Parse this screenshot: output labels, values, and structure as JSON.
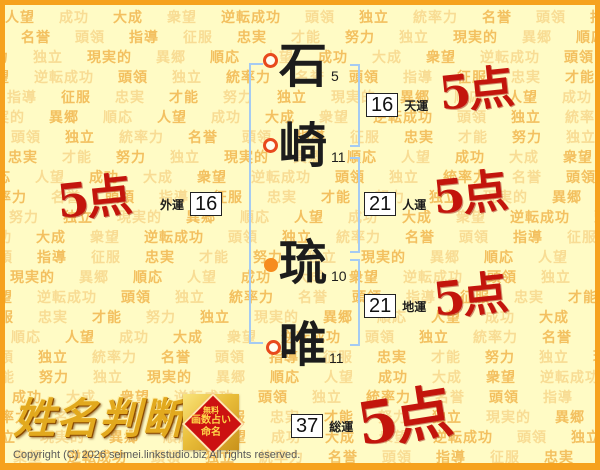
{
  "name_analysis": {
    "characters": [
      {
        "char": "石",
        "strokes": "5",
        "marker": "hollow"
      },
      {
        "char": "崎",
        "strokes": "11",
        "marker": "hollow"
      },
      {
        "char": "琉",
        "strokes": "10",
        "marker": "filled"
      },
      {
        "char": "唯",
        "strokes": "11",
        "marker": "hollow"
      }
    ],
    "luck": [
      {
        "id": "tenun",
        "label": "天運",
        "value": "16",
        "score": "5点"
      },
      {
        "id": "jinun",
        "label": "人運",
        "value": "21",
        "score": "5点"
      },
      {
        "id": "chiun",
        "label": "地運",
        "value": "21",
        "score": "5点"
      },
      {
        "id": "gaiun",
        "label": "外運",
        "value": "16",
        "score": "5点"
      },
      {
        "id": "souun",
        "label": "総運",
        "value": "37",
        "score": "5点"
      }
    ]
  },
  "background_words": [
    "人望",
    "成功",
    "大成",
    "衆望",
    "逆転成功",
    "頭領",
    "独立",
    "統率力",
    "名誉",
    "頭領",
    "指導",
    "征服",
    "忠実",
    "才能",
    "努力",
    "独立",
    "現実的",
    "異郷",
    "順応"
  ],
  "footer": {
    "logo_text": "姓名判断",
    "badge": {
      "line1": "無料",
      "line2": "画数占い",
      "line3": "命名"
    },
    "copyright": "Copyright (C) 2026 seimei.linkstudio.biz All rights reserved."
  },
  "colors": {
    "page_background": "#FFFBC5",
    "frame_orange": "#F6A21E",
    "bracket_blue": "#A5CBF2",
    "score_red": "#C3150C",
    "marker_hollow_ring": "#E8491D",
    "marker_filled_orange": "#F68C1E",
    "pattern_word_light": "#F8DC94",
    "pattern_word_dark": "#F3C060",
    "logo_gold": "#E2A91E",
    "badge_red": "#CC1111"
  }
}
